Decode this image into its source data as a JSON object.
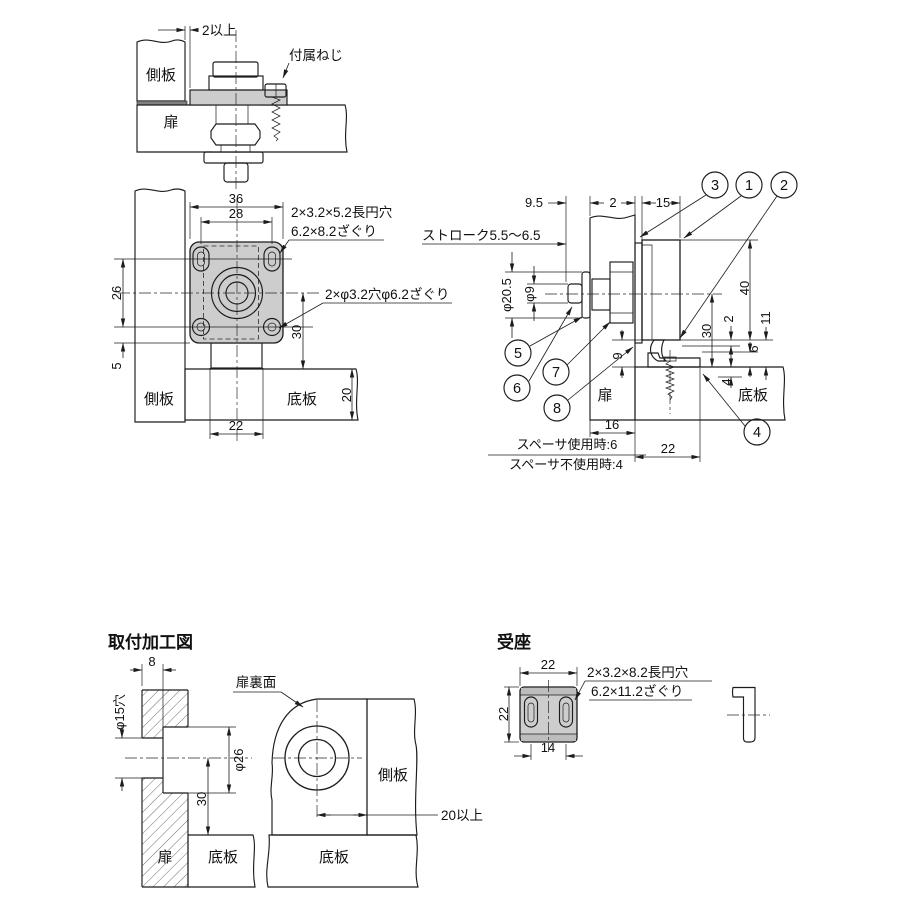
{
  "top_section": {
    "gap_note": "2以上",
    "screw_label": "付属ねじ",
    "side_panel": "側板",
    "door": "扉"
  },
  "front_view": {
    "dim_36": "36",
    "dim_28": "28",
    "dim_26": "26",
    "dim_5": "5",
    "dim_30": "30",
    "dim_20": "20",
    "dim_22": "22",
    "slot_note_1": "2×3.2×5.2長円穴",
    "slot_note_2": "6.2×8.2ざぐり",
    "hole_note": "2×φ3.2穴φ6.2ざぐり",
    "side_panel": "側板",
    "bottom_panel": "底板"
  },
  "side_view": {
    "dim_9_5": "9.5",
    "dim_2_top": "2",
    "dim_15": "15",
    "stroke_note": "ストローク5.5～6.5",
    "dia_20_5": "φ20.5",
    "dia_9": "φ9",
    "dim_40": "40",
    "dim_30": "30",
    "dim_2_right": "2",
    "dim_11": "11",
    "dim_6": "6",
    "dim_4": "4",
    "dim_9": "9",
    "dim_16": "16",
    "dim_22": "22",
    "spacer_used": "スペーサ使用時:6",
    "spacer_not_used": "スペーサ不使用時:4",
    "door": "扉",
    "bottom_panel": "底板",
    "callouts": {
      "c1": "1",
      "c2": "2",
      "c3": "3",
      "c4": "4",
      "c5": "5",
      "c6": "6",
      "c7": "7",
      "c8": "8"
    }
  },
  "mounting_diagram": {
    "title": "取付加工図",
    "dim_8": "8",
    "hole_15": "φ15穴",
    "dia_26": "φ26",
    "dim_30": "30",
    "door_back_label": "扉裏面",
    "side_panel": "側板",
    "min_20": "20以上",
    "door": "扉",
    "bottom_panel_1": "底板",
    "bottom_panel_2": "底板"
  },
  "catch": {
    "title": "受座",
    "dim_22_w": "22",
    "dim_22_h": "22",
    "dim_14": "14",
    "slot_note_1": "2×3.2×8.2長円穴",
    "slot_note_2": "6.2×11.2ざぐり"
  }
}
